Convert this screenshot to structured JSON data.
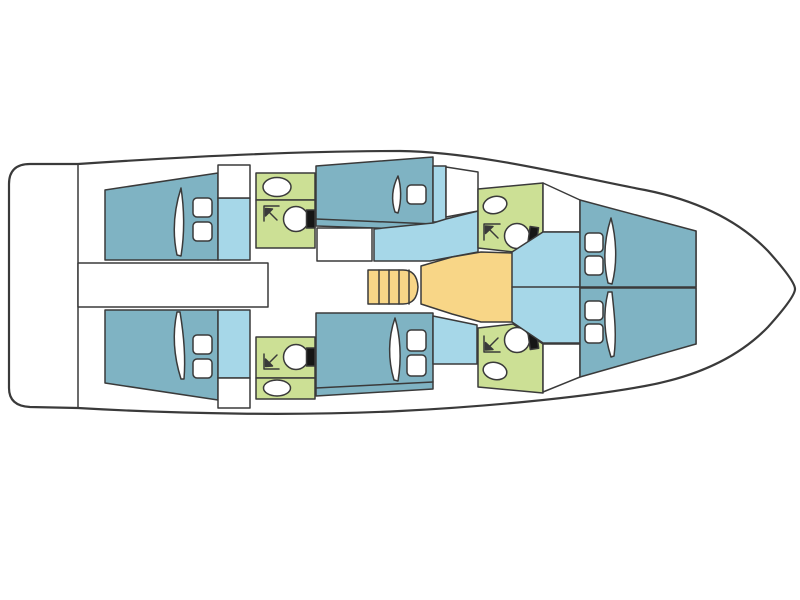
{
  "plan": {
    "type": "yacht-interior-floor-plan",
    "orientation": "bow-right",
    "cabin_count": 6,
    "bathroom_count": 4,
    "berth_pillow_count": 6,
    "hatch_cushion_count": 11
  },
  "colors": {
    "outline": "#3a3a3a",
    "hull": "#ffffff",
    "deck": "#ffffff",
    "cabin": "#7fb3c3",
    "walkway": "#a6d7e8",
    "bathroom": "#cce095",
    "salon": "#f8d687",
    "fixture": "#ffffff",
    "toilet_tank": "#161616",
    "background": "#ffffff"
  }
}
